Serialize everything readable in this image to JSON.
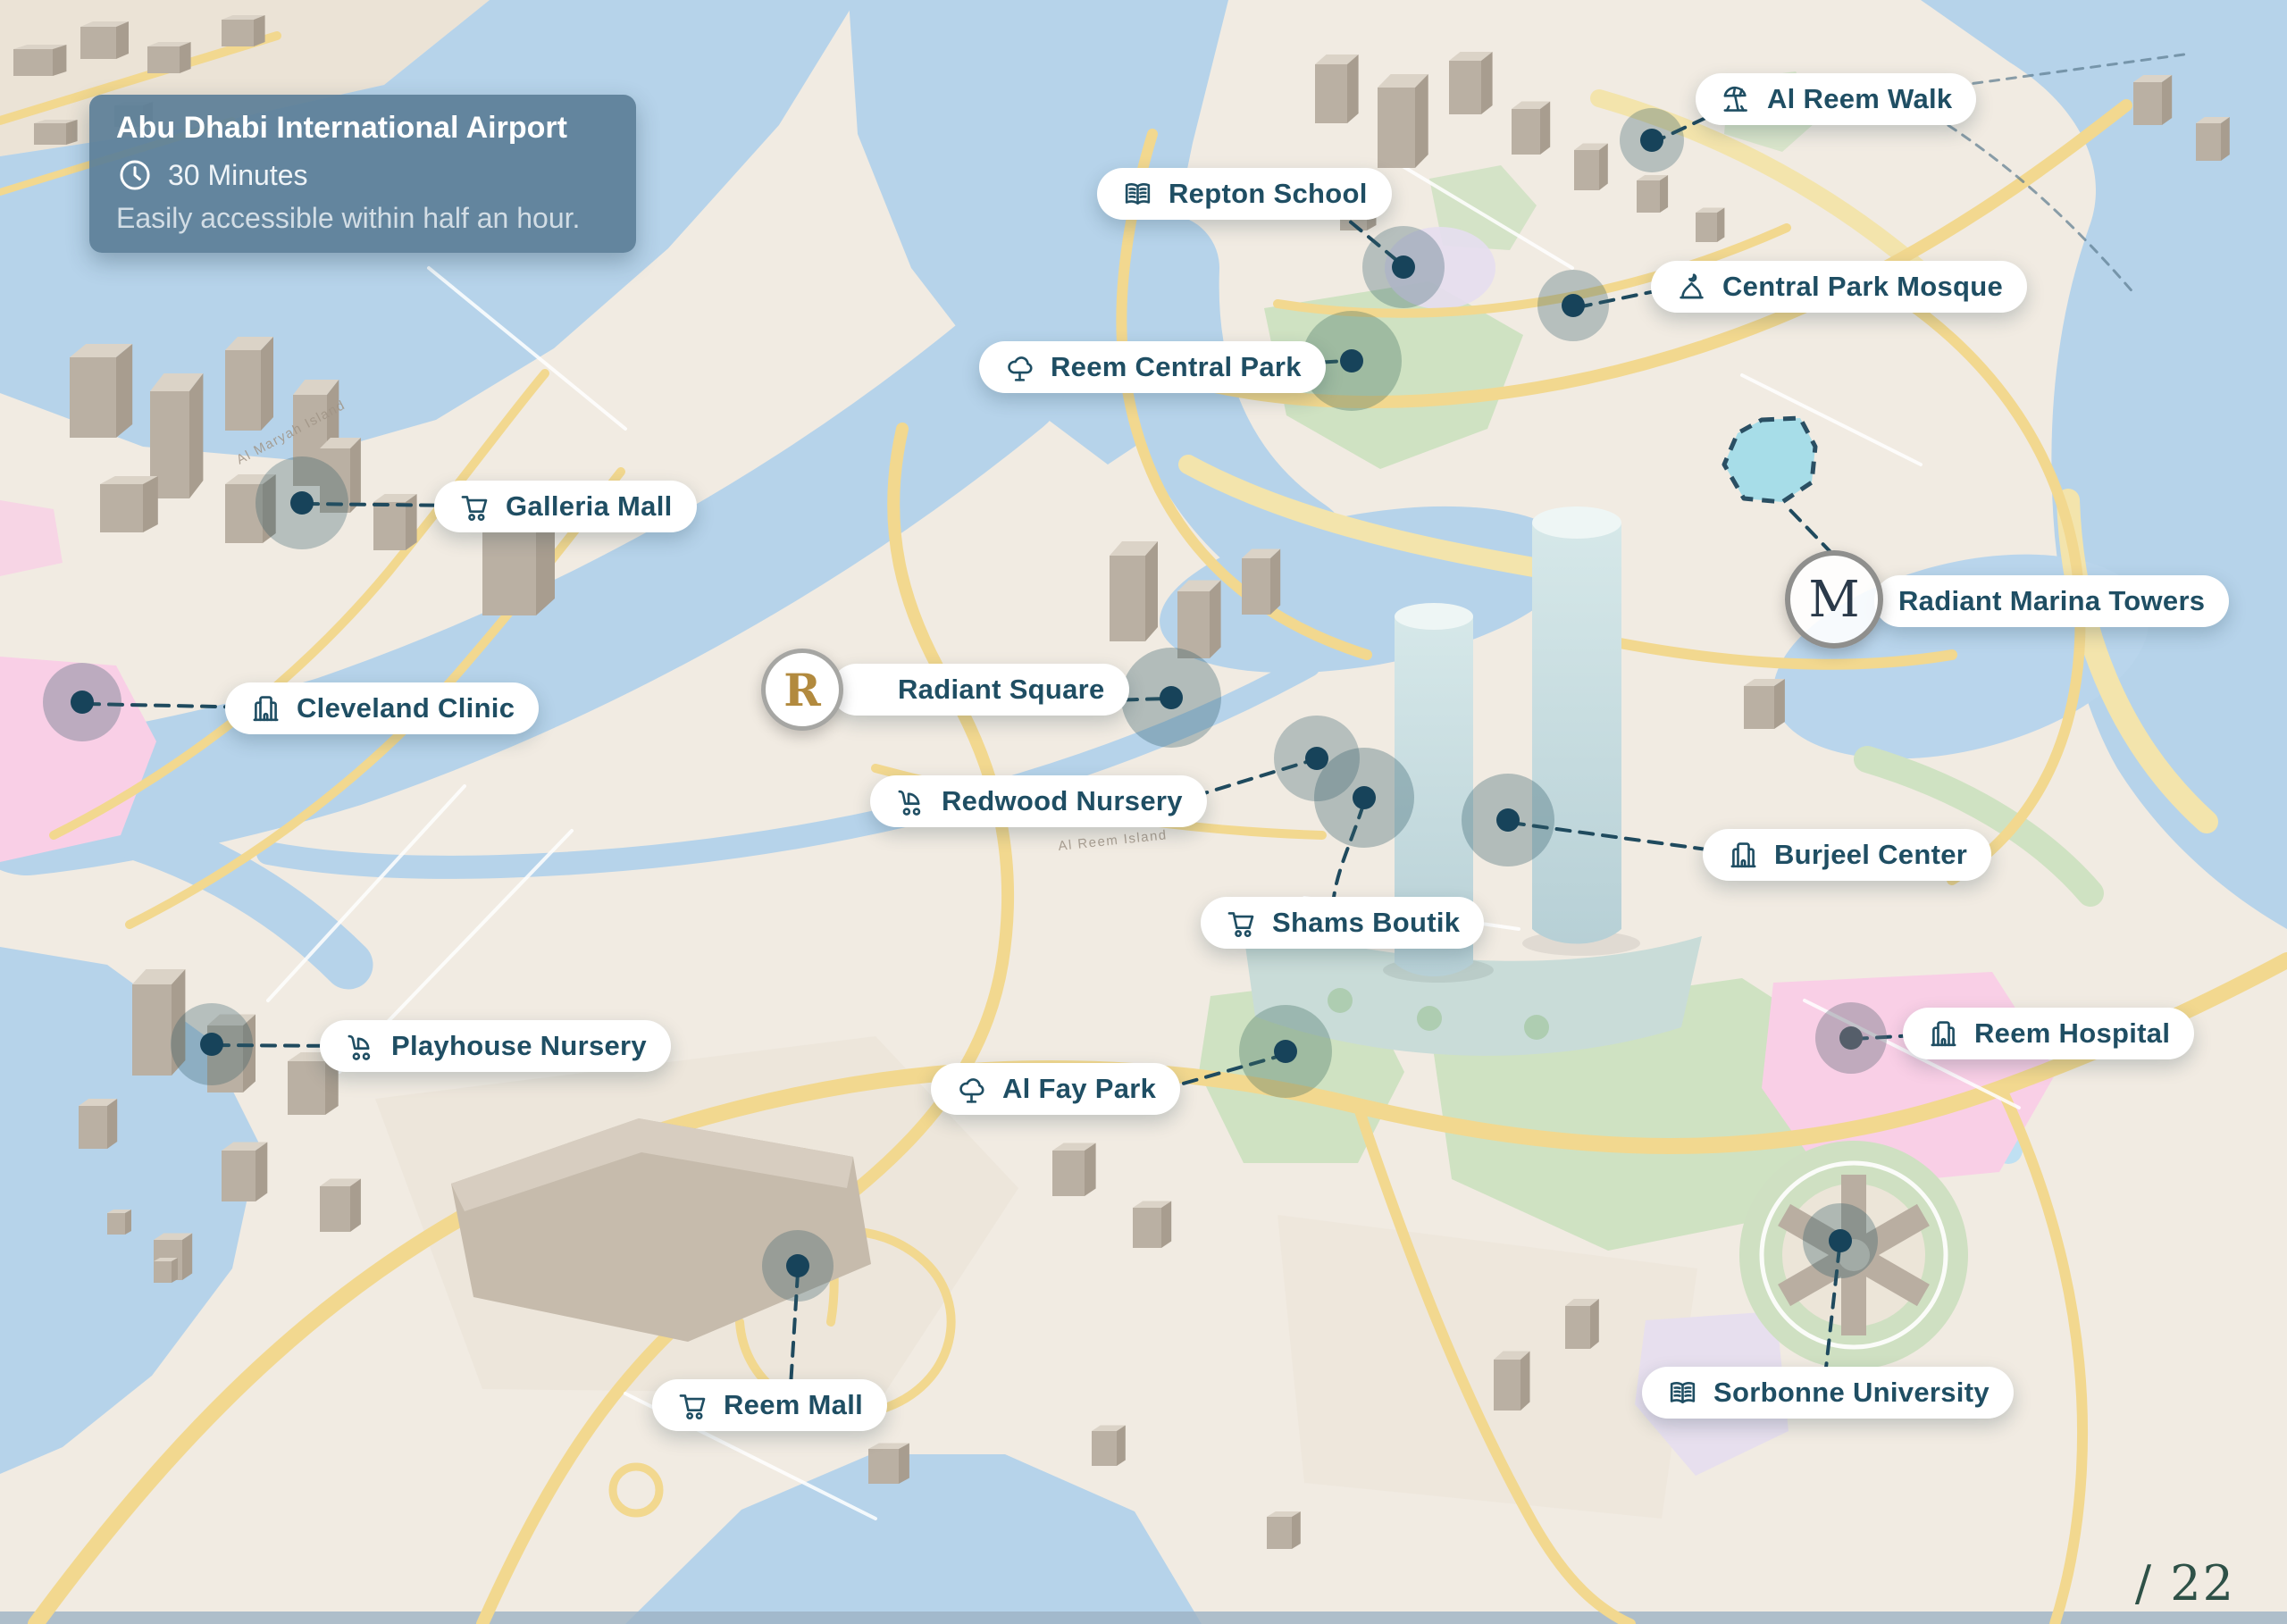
{
  "page": {
    "number": "/ 22"
  },
  "airport_card": {
    "title": "Abu Dhabi International Airport",
    "time": "30 Minutes",
    "note": "Easily accessible within half an hour."
  },
  "branding": {
    "radiant_square_monogram": "R",
    "radiant_marina_monogram": "M"
  },
  "map": {
    "area_labels": [
      "Al Maryah Island",
      "Al Reem Island"
    ]
  },
  "colors": {
    "pill_text": "#1f4e63",
    "pin": "#17435a",
    "connector": "#1f4a5e",
    "card_background": "#5d7f98",
    "gold_monogram": "#b28a3e",
    "page_number": "#2e5147",
    "water": "#b6d3ea",
    "land": "#f1ebe2",
    "park": "#cfe2c2",
    "road": "#f2d88f",
    "hospital_zone": "#f9cfe6",
    "highlight_parcel": "#9fdbe9"
  },
  "locations": [
    {
      "id": "al-reem-walk",
      "label": "Al Reem Walk",
      "icon": "beach-umbrella"
    },
    {
      "id": "repton-school",
      "label": "Repton School",
      "icon": "open-book"
    },
    {
      "id": "central-park-mosque",
      "label": "Central Park Mosque",
      "icon": "mosque"
    },
    {
      "id": "reem-central-park",
      "label": "Reem Central Park",
      "icon": "tree"
    },
    {
      "id": "galleria-mall",
      "label": "Galleria Mall",
      "icon": "shopping-cart"
    },
    {
      "id": "radiant-marina-towers",
      "label": "Radiant Marina Towers",
      "icon": "monogram-m"
    },
    {
      "id": "cleveland-clinic",
      "label": "Cleveland Clinic",
      "icon": "building"
    },
    {
      "id": "radiant-square",
      "label": "Radiant Square",
      "icon": "monogram-r"
    },
    {
      "id": "redwood-nursery",
      "label": "Redwood Nursery",
      "icon": "stroller"
    },
    {
      "id": "burjeel-center",
      "label": "Burjeel Center",
      "icon": "building"
    },
    {
      "id": "shams-boutik",
      "label": "Shams Boutik",
      "icon": "shopping-cart"
    },
    {
      "id": "playhouse-nursery",
      "label": "Playhouse Nursery",
      "icon": "stroller"
    },
    {
      "id": "al-fay-park",
      "label": "Al Fay Park",
      "icon": "tree"
    },
    {
      "id": "reem-hospital",
      "label": "Reem Hospital",
      "icon": "building"
    },
    {
      "id": "reem-mall",
      "label": "Reem Mall",
      "icon": "shopping-cart"
    },
    {
      "id": "sorbonne-university",
      "label": "Sorbonne University",
      "icon": "open-book"
    }
  ]
}
